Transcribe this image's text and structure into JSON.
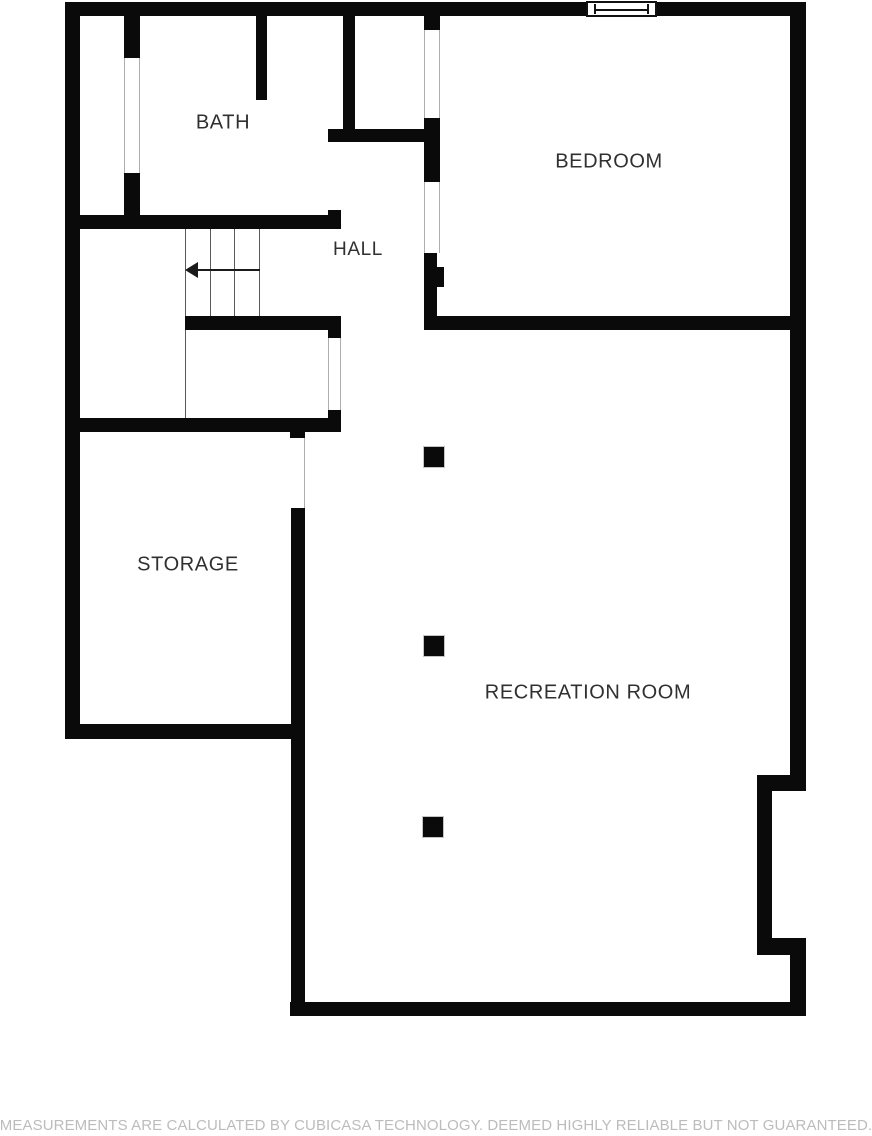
{
  "rooms": {
    "bath": {
      "label": "BATH"
    },
    "hall": {
      "label": "HALL"
    },
    "bedroom": {
      "label": "BEDROOM"
    },
    "storage": {
      "label": "STORAGE"
    },
    "recreation": {
      "label": "RECREATION ROOM"
    }
  },
  "footer": {
    "disclaimer": "MEASUREMENTS ARE CALCULATED BY CUBICASA TECHNOLOGY. DEEMED HIGHLY RELIABLE BUT NOT GUARANTEED."
  },
  "features": {
    "window_icon": "window-icon",
    "stairs_icon": "stairs-down-arrow-icon",
    "column_icon": "structural-column",
    "column_count": 3
  },
  "colors": {
    "background": "#ffffff",
    "wall": "#0a0a0a",
    "label_text": "#303030",
    "stair_line": "#5a5a5a",
    "opening_line": "#adadad",
    "column_border": "#c4c4c4",
    "disclaimer_text": "#bcbcbc"
  }
}
